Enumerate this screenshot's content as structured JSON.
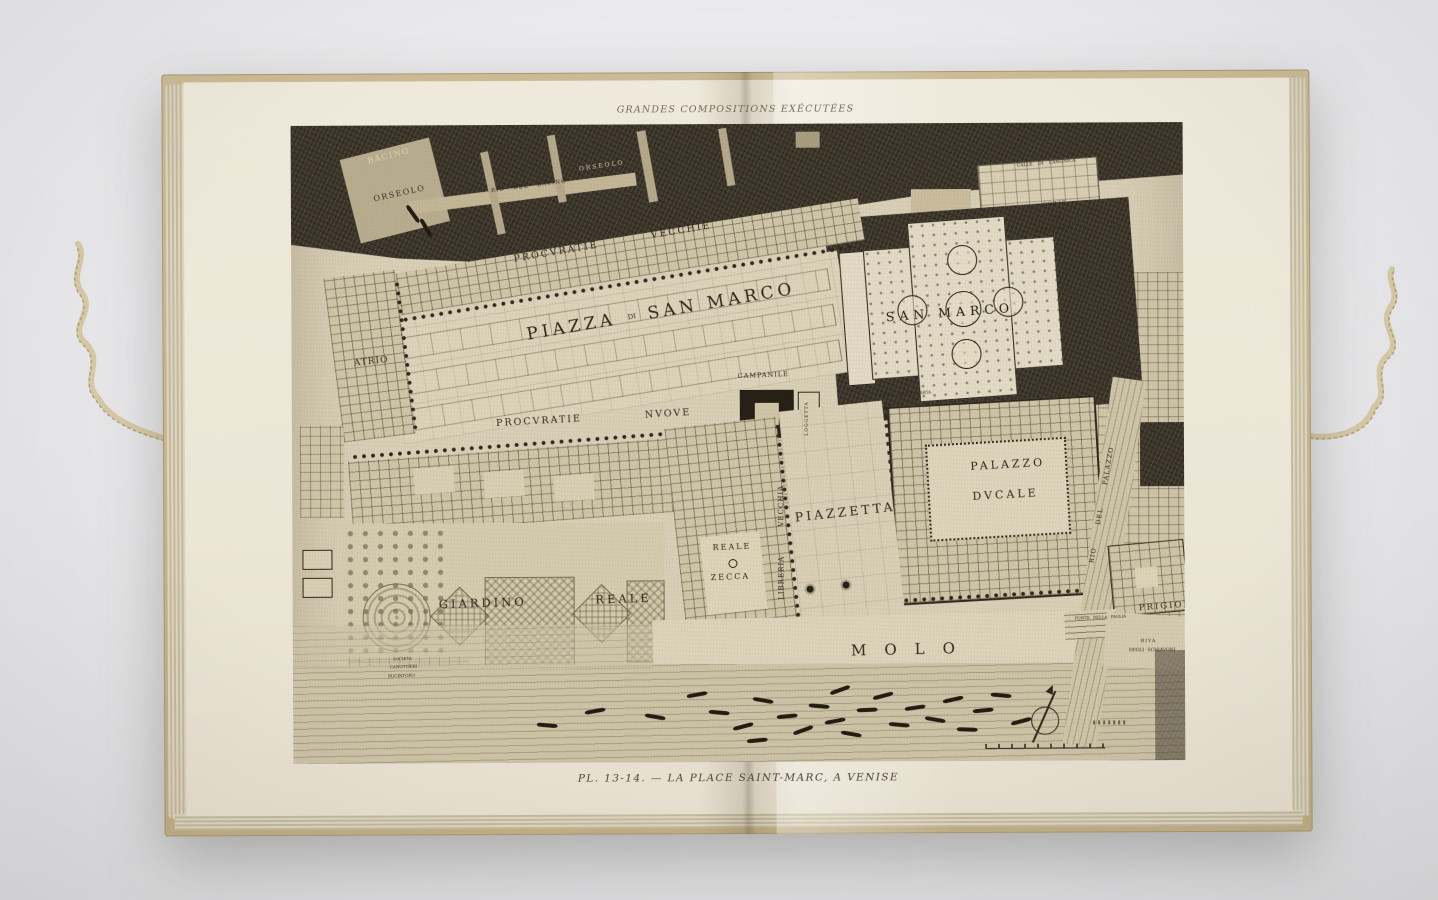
{
  "book": {
    "header": "GRANDES COMPOSITIONS EXÉCUTÉES",
    "caption": "PL. 13-14. — LA PLACE SAINT-MARC, A VENISE"
  },
  "map": {
    "labels": {
      "bacino": "BACINO",
      "orseolo_basin": "ORSEOLO",
      "rio_del_bacino": "RIO DEL BACINO",
      "orseolo_canal": "ORSEOLO",
      "procuratie_vecchie": "PROCVRATIE VECCHIE",
      "piazza": "PIAZZA",
      "di": "DI",
      "san_marco": "SAN MARCO",
      "atrio": "ATRIO",
      "procuratie_nuove": "PROCVRATIE NVOVE",
      "campanile": "CAMPANILE",
      "loggetta": "LOGGETTA",
      "basilica": "SAN MARCO",
      "calle_di_canonica": "CALLE DI CANONICA",
      "corte": "CORTE",
      "di_canonica": "DI",
      "canonica": "CANONICA",
      "porta_della_carta": "PORTA DELLA CARTA",
      "palazzo": "PALAZZO",
      "ducale": "DVCALE",
      "piazzetta": "PIAZZETTA",
      "libreria_vecchia": "LIBRERIA VECCHIA",
      "reale": "REALE",
      "zecca": "ZECCA",
      "giardino_reale": "GIARDINO REALE",
      "molo": "MOLO",
      "rio_del_palazzo": "RIO DEL PALAZZO",
      "prigioni": "PRIGIONI",
      "ponte_della_paglia": "PONTE DELLA PAGLIA",
      "riva": "RIVA",
      "degli_schiavoni": "DEGLI SCHIAVONI",
      "societa": "SOCIETA",
      "canottieri": "CANOTTIERI",
      "bucintoro": "BUCINTORO"
    }
  },
  "colors": {
    "backdrop": "#e9e9eb",
    "cover": "#c5b28c",
    "paper": "#ece6d7",
    "plate_paper": "#d9d0b8",
    "dark_hatch": "#3a3328",
    "ink": "#2d261d"
  }
}
